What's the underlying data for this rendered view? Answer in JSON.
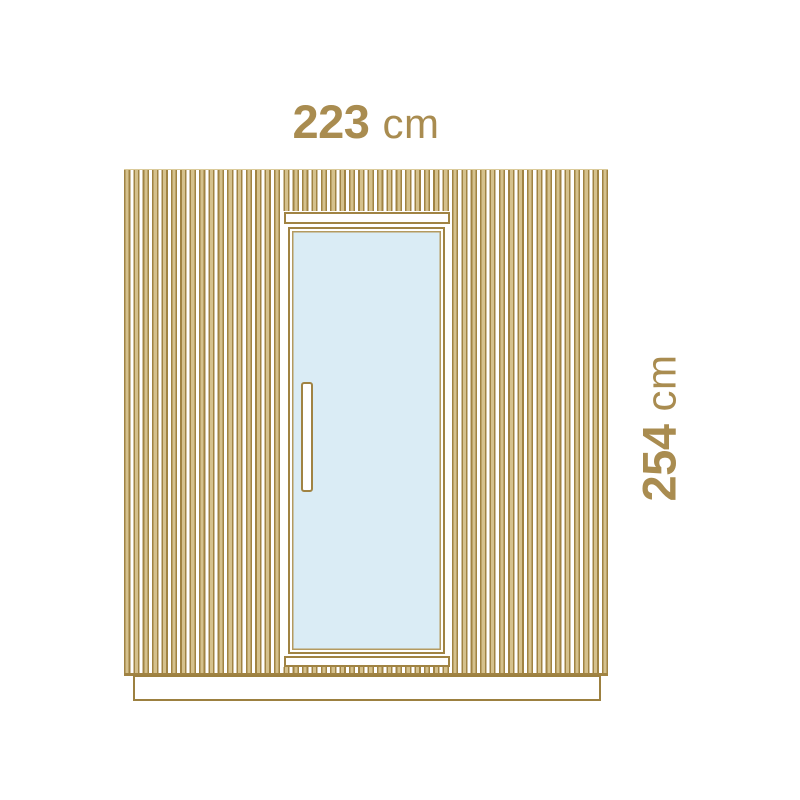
{
  "diagram": {
    "type": "dimension-diagram",
    "subject": "sauna-cabin-front-elevation",
    "dimensions": {
      "width": {
        "value": "223",
        "unit": "cm"
      },
      "height": {
        "value": "254",
        "unit": "cm"
      }
    },
    "colors": {
      "outline_gold": "#a08343",
      "slat_fill": "#d5c18d",
      "label_text": "#a98c50",
      "glass_blue": "#daecf5",
      "panel_fill": "#ffffff",
      "background": "#ffffff"
    }
  }
}
